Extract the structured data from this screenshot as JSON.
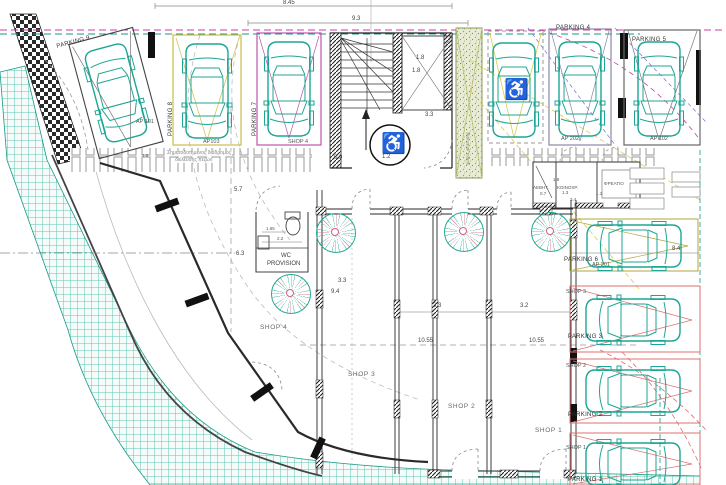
{
  "stalls": {
    "p9": {
      "name": "PARKING 9",
      "unit": "AP 101"
    },
    "p8": {
      "name": "PARKING 8",
      "unit": "AP103"
    },
    "p7": {
      "name": "PARKING 7",
      "unit": "SHOP 4"
    },
    "p4": {
      "name": "PARKING 4",
      "unit": "AP 202"
    },
    "p5": {
      "name": "PARKING 5",
      "unit": "AP 102"
    },
    "p6": {
      "name": "PARKING 6",
      "unit": "AP 201"
    },
    "p3": {
      "name": "PARKING 3",
      "unit": "SHOP 3"
    },
    "p2": {
      "name": "PARKING 2",
      "unit": "SHOP 2"
    },
    "p1": {
      "name": "PARKING 1",
      "unit": "SHOP 1"
    }
  },
  "shops": {
    "s1": "SHOP 1",
    "s2": "SHOP 2",
    "s3": "SHOP 3",
    "s4": "SHOP 4"
  },
  "rooms": {
    "wc_line1": "WC",
    "wc_line2": "PROVISION",
    "boiler": "ΛΕΒΗΤ.",
    "common": "ΚΟΙΝΟΧΡ.",
    "shaft": "ΦΡΕΑΤΙΟ"
  },
  "notes": {
    "pedestrian_1": "Σηματοδοτημένος διάδρομος",
    "pedestrian_2": "διέλευσης πεζών",
    "planting": "χώρος φύτευσης"
  },
  "dimensions": {
    "d845": "8.45",
    "d93": "9.3",
    "d18": "1.8",
    "d33": "3.3",
    "d12": "1.2",
    "d10": "1.0",
    "d09": "0.9",
    "d57": "5.7",
    "d63": "6.3",
    "d165": "1.65",
    "d22": "2.2",
    "d94": "9.4",
    "d32": "3.2",
    "d1055": "10.55",
    "d84": "8.4",
    "d07": "0.7",
    "d13": "1.3",
    "d34": "3.4",
    "d11": "1.1"
  },
  "icons": {
    "wheelchair": "♿"
  },
  "colors": {
    "car_teal": "#1da693",
    "band_teal": "#5fc6b2",
    "stall_yellow": "#ccbf45",
    "stall_magenta": "#bd53ad",
    "stall_red": "#dd7070",
    "boundary_magenta": "#c43f9f",
    "boundary_teal": "#169a87"
  }
}
